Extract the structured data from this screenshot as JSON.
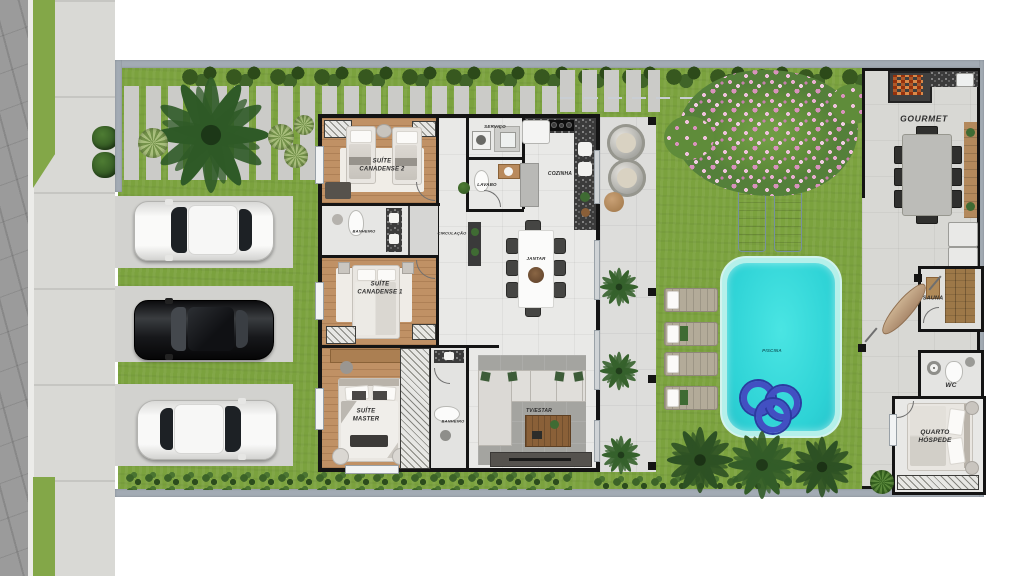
{
  "rooms": {
    "suite_canadense_2": {
      "label": "SUÍTE\nCANADENSE 2"
    },
    "banheiro_suites": {
      "label": "BANHEIRO"
    },
    "circulacao": {
      "label": "CIRCULAÇÃO"
    },
    "suite_canadense_1": {
      "label": "SUÍTE\nCANADENSE 1"
    },
    "suite_master": {
      "label": "SUÍTE\nMASTER"
    },
    "banheiro_master": {
      "label": "BANHEIRO"
    },
    "servico": {
      "label": "SERVIÇO"
    },
    "lavabo": {
      "label": "LAVABO"
    },
    "cozinha": {
      "label": "COZINHA"
    },
    "jantar": {
      "label": "JANTAR"
    },
    "tv_estar": {
      "label": "TV/ESTAR"
    },
    "piscina": {
      "label": "PISCINA"
    },
    "gourmet": {
      "label": "GOURMET"
    },
    "sauna": {
      "label": "SAUNA"
    },
    "wc": {
      "label": "WC"
    },
    "quarto_hospede": {
      "label": "QUARTO\nHÓSPEDE"
    }
  },
  "colors": {
    "grass": "#7ba23e",
    "pool_water": "#35d9d8",
    "asphalt": "#9b9b9b",
    "sidewalk": "#d9d9d5",
    "boundary_wall": "#a3abb4",
    "interior_wall": "#141414",
    "wood_floor": "#c09165",
    "tile_floor": "#e9e9e7",
    "hedge_green": "#33551f",
    "blossom_pink": "#e3a6cd",
    "pool_float_blue": "#4250c2"
  },
  "objects": {
    "cars": [
      {
        "name": "white-suv",
        "color": "#f4f4f2"
      },
      {
        "name": "black-sedan",
        "color": "#141416"
      },
      {
        "name": "white-car",
        "color": "#f4f4f2"
      }
    ],
    "pool_float_count": 3,
    "garden_lounger_count": 4,
    "deck_lounger_count": 2,
    "indoor_dining_seats": 8,
    "gourmet_dining_seats": 8
  }
}
